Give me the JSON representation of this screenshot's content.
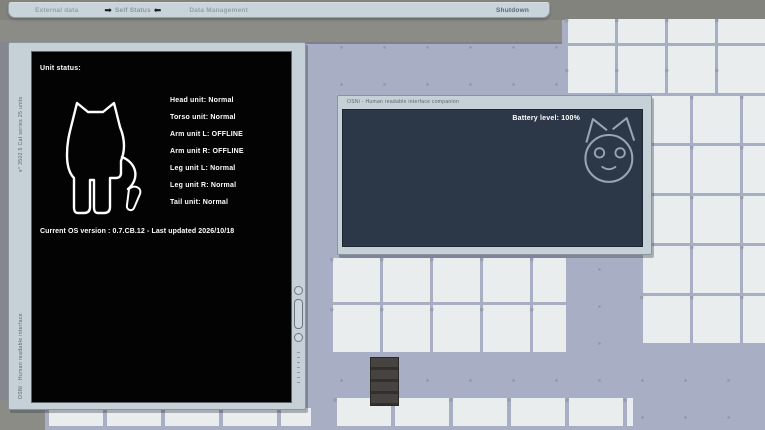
{
  "menu": {
    "items": [
      {
        "label": "External data"
      },
      {
        "label": "Self Status",
        "selected": true
      },
      {
        "label": "Data Management"
      }
    ],
    "selected_marker_left": "➡",
    "selected_marker_right": "⬅",
    "shutdown_label": "Shutdown"
  },
  "status_window": {
    "side_label_top": "v° 3502.5 Cat series 25 units",
    "side_label_bottom": "OSNi : Human readable interface",
    "heading": "Unit status:",
    "units": [
      {
        "name": "Head unit",
        "status": "Normal"
      },
      {
        "name": "Torso unit",
        "status": "Normal"
      },
      {
        "name": "Arm unit L",
        "status": "OFFLINE"
      },
      {
        "name": "Arm unit R",
        "status": "OFFLINE"
      },
      {
        "name": "Leg unit L",
        "status": "Normal"
      },
      {
        "name": "Leg unit R",
        "status": "Normal"
      },
      {
        "name": "Tail unit",
        "status": "Normal"
      }
    ],
    "os_version_line": "Current OS version : 0.7.CB.12 - Last updated 2026/10/18"
  },
  "companion_window": {
    "title": "OSNi - Human readable interface companion",
    "battery_label": "Battery level: 100%"
  },
  "colors": {
    "screen_black": "#030303",
    "panel_frame": "#c6d0d7",
    "companion_navy": "#2c3748",
    "floor_path": "#a8aec3",
    "floor_tile": "#e9edee",
    "top_band_gray": "#8c8c86"
  }
}
